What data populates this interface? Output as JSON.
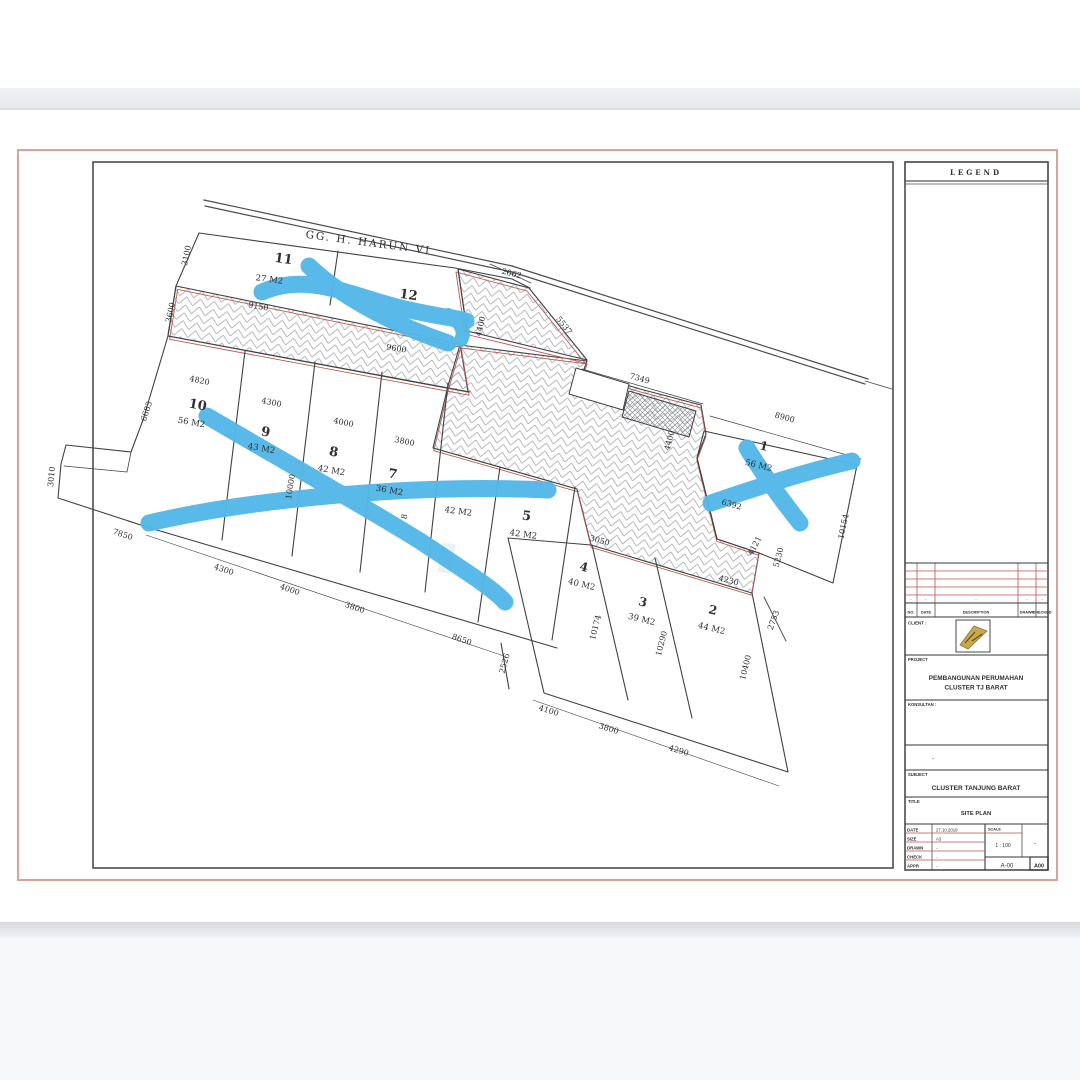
{
  "page": {
    "legend_title": "LEGEND"
  },
  "street": {
    "name": "GG. H. HARUN VI"
  },
  "lots": [
    {
      "no": "1",
      "area": "56 M2"
    },
    {
      "no": "2",
      "area": "44 M2"
    },
    {
      "no": "3",
      "area": "39 M2"
    },
    {
      "no": "4",
      "area": "40 M2"
    },
    {
      "no": "5",
      "area": "42 M2"
    },
    {
      "no": "6",
      "area": "42 M2"
    },
    {
      "no": "7",
      "area": "36 M2"
    },
    {
      "no": "8",
      "area": "42 M2"
    },
    {
      "no": "9",
      "area": "43 M2"
    },
    {
      "no": "10",
      "area": "56 M2"
    },
    {
      "no": "11",
      "area": "27 M2"
    },
    {
      "no": "12",
      "area": ""
    }
  ],
  "dimensions": [
    "3100",
    "3600",
    "9150",
    "9600",
    "2062",
    "5537",
    "4400",
    "4400",
    "7349",
    "8900",
    "4820",
    "4300",
    "4000",
    "3800",
    "6683",
    "3010",
    "7850",
    "4300",
    "4000",
    "3800",
    "8650",
    "10000",
    "2526",
    "3050",
    "10174",
    "10290",
    "10400",
    "4230",
    "5230",
    "4121",
    "6392",
    "10154",
    "2753",
    "4100",
    "3800",
    "4290",
    "8"
  ],
  "title_block": {
    "revision_headers": [
      "NO.",
      "DATE",
      "DESCRIPTION",
      "DRAWN",
      "CHECKED"
    ],
    "revision_dashes": [
      "-",
      "-",
      "-",
      "-",
      "-"
    ],
    "client_label": "CLIENT :",
    "project_label": "PROJECT",
    "project_name_line1": "PEMBANGUNAN PERUMAHAN",
    "project_name_line2": "CLUSTER TJ BARAT",
    "consultant_label": "KONSULTAN :",
    "note_dash": "-",
    "subject_label": "SUBJECT",
    "subject": "CLUSTER TANJUNG BARAT",
    "title_label": "TITLE",
    "title": "SITE PLAN",
    "info_rows": [
      {
        "label": "DATE",
        "value": "27.10.2019"
      },
      {
        "label": "SIZE",
        "value": "A3"
      },
      {
        "label": "DRAWN",
        "value": "-"
      },
      {
        "label": "CHECK",
        "value": "-"
      },
      {
        "label": "APPR",
        "value": "-"
      }
    ],
    "scale_label": "SCALE",
    "scale_value": "1 : 100",
    "scale_dash": "-",
    "sheet_no": "A-00",
    "sheet_tag": "A00"
  },
  "colors": {
    "marker_blue": "#54b7e8",
    "page_border_red": "#d8a39a",
    "cad_red": "#b85a50",
    "table_red": "#c0504d",
    "line_dark": "#3f4144",
    "hatch_gray": "#a6a9ae"
  }
}
